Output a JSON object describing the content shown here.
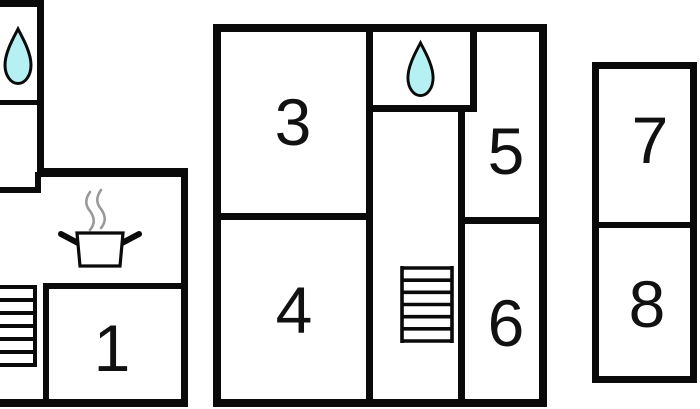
{
  "palette": {
    "background": "#ffffff",
    "wall": "#0a0a0a",
    "water_drop_fill": "#b5f1f3",
    "steam": "#999999",
    "label": "#111111"
  },
  "rooms": {
    "r1": {
      "label": "1"
    },
    "r3": {
      "label": "3"
    },
    "r4": {
      "label": "4"
    },
    "r5": {
      "label": "5"
    },
    "r6": {
      "label": "6"
    },
    "r7": {
      "label": "7"
    },
    "r8": {
      "label": "8"
    }
  },
  "icons": {
    "water_drop": "water-drop-icon",
    "cooking_pot": "cooking-pot-icon",
    "stairs": "stairs-icon"
  },
  "buildings": {
    "left_wing_rooms": [
      "1"
    ],
    "main_building_rooms": [
      "3",
      "4",
      "5",
      "6"
    ],
    "right_wing_rooms": [
      "7",
      "8"
    ]
  }
}
